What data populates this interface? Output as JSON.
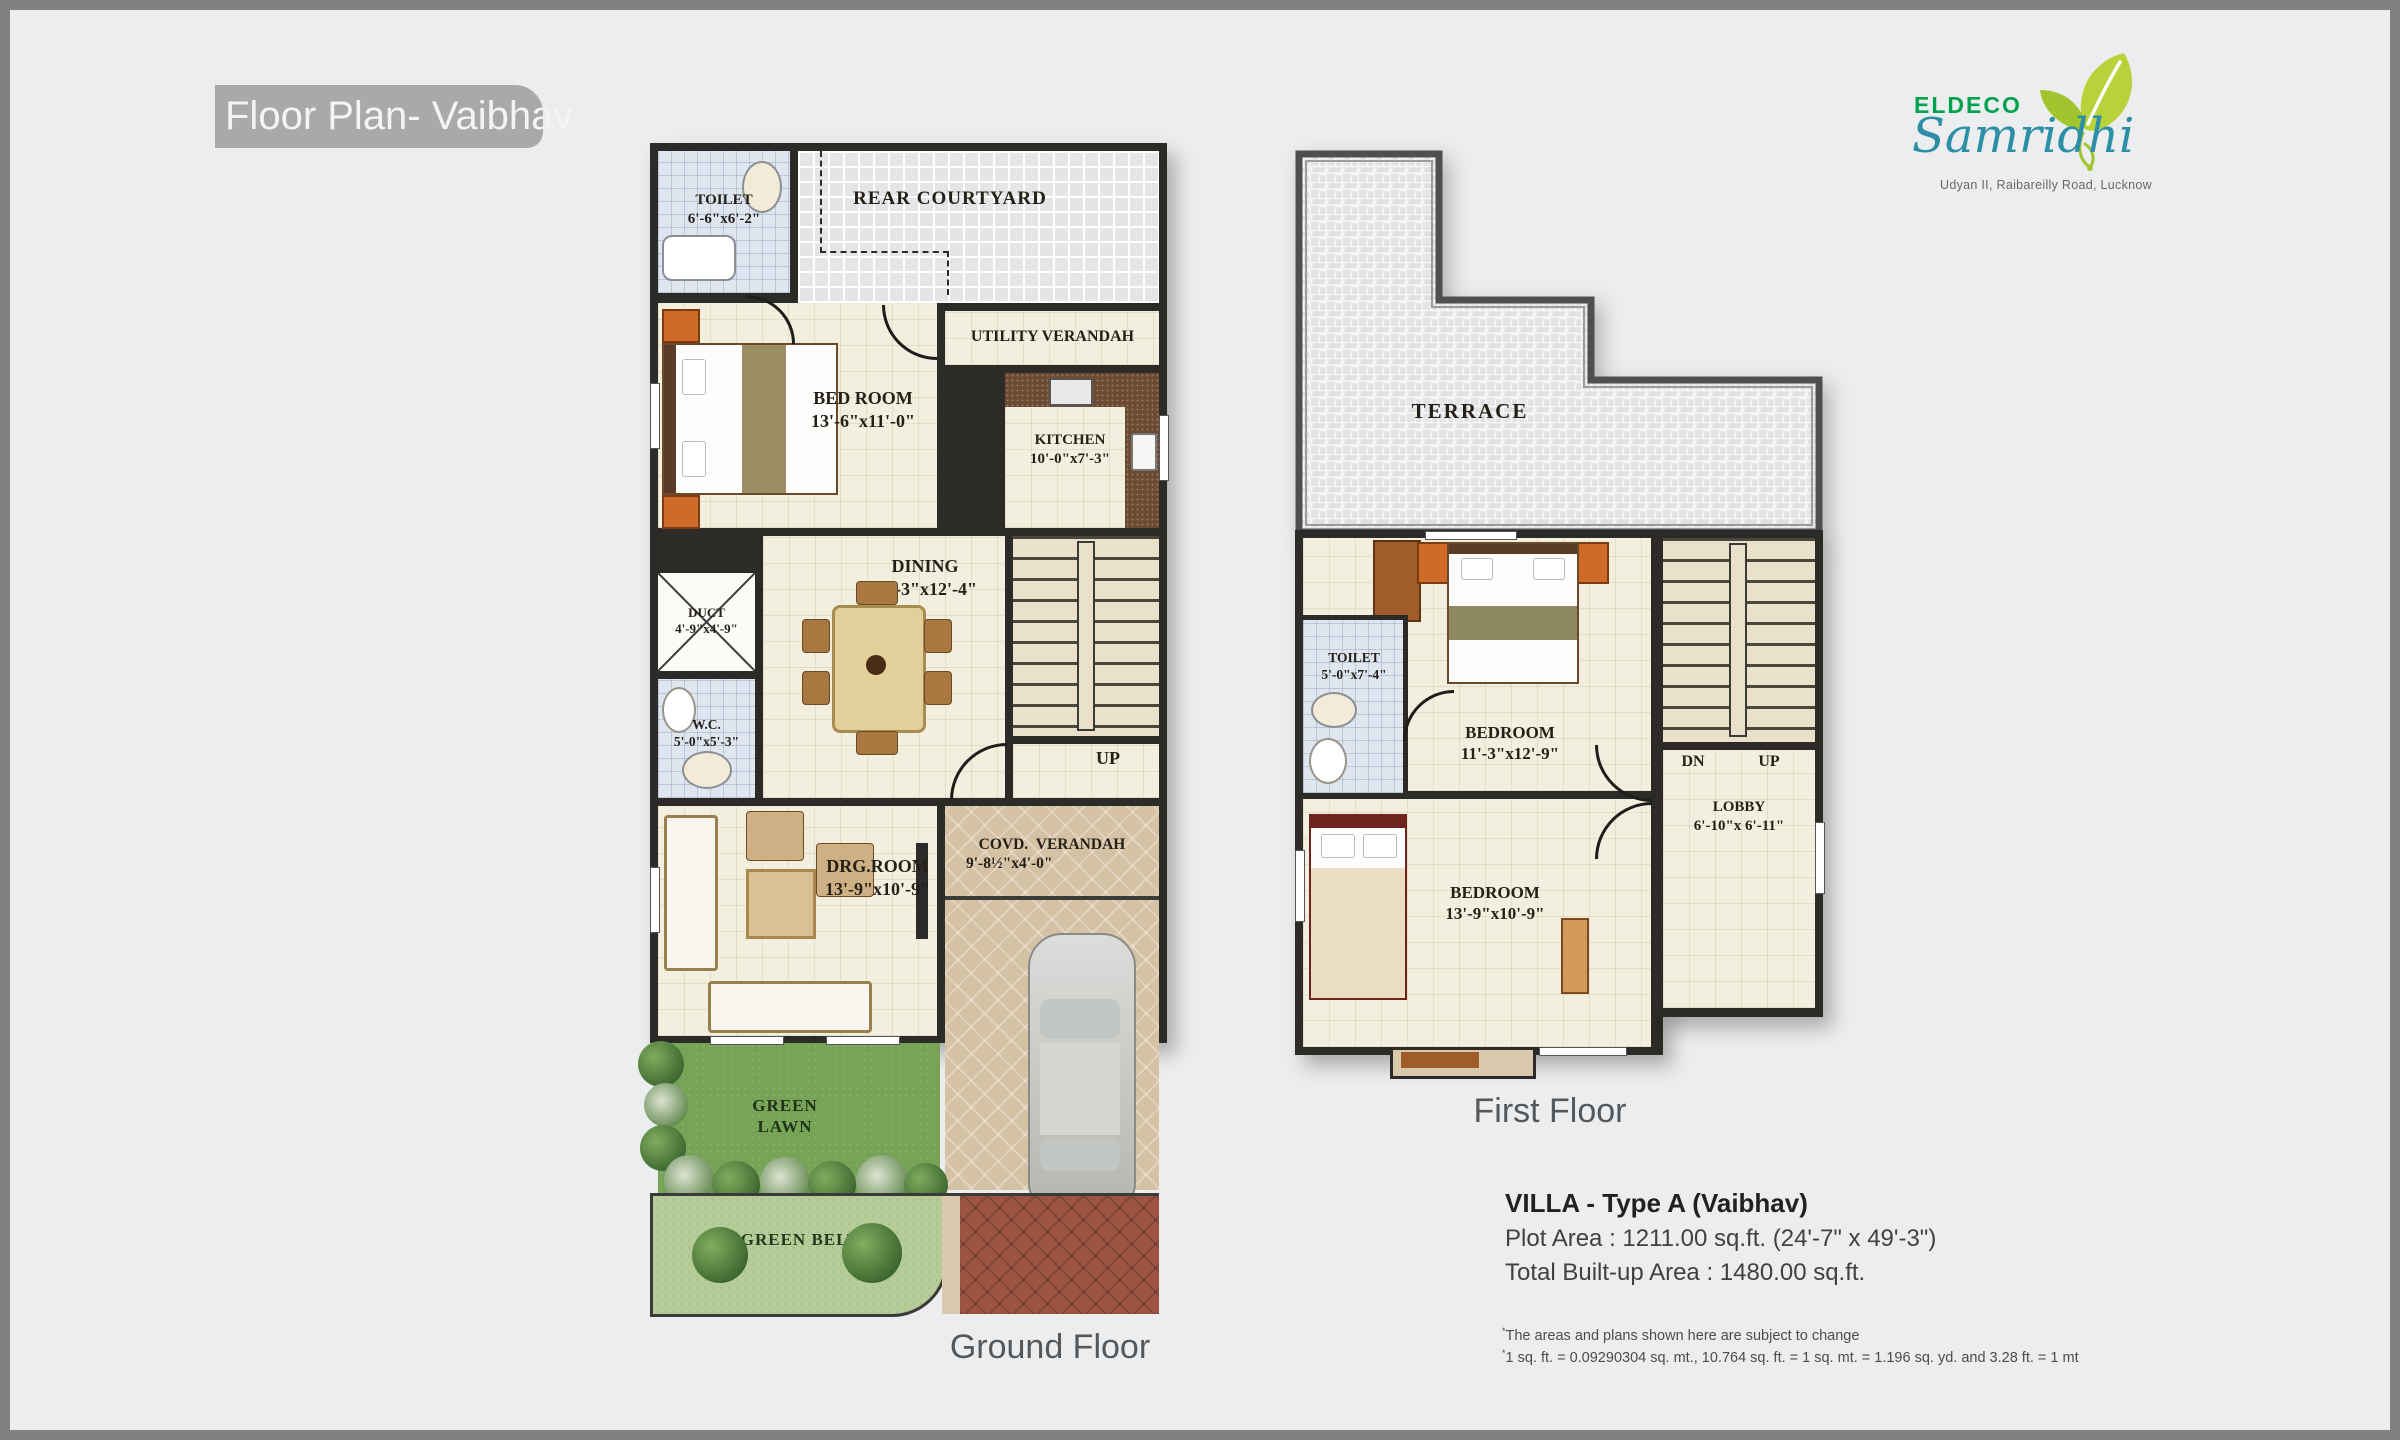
{
  "title": "Floor Plan- Vaibhav",
  "logo": {
    "brand": "ELDECO",
    "project": "Samridhi",
    "address": "Udyan II, Raibareilly Road, Lucknow"
  },
  "ground_floor": {
    "label": "Ground Floor",
    "toilet": {
      "name": "TOILET",
      "dims": "6'-6\"x6'-2\""
    },
    "rear_courtyard": {
      "name": "REAR COURTYARD"
    },
    "bed_room": {
      "name": "BED ROOM",
      "dims": "13'-6\"x11'-0\""
    },
    "utility_verandah": {
      "name": "UTILITY VERANDAH"
    },
    "kitchen": {
      "name": "KITCHEN",
      "dims": "10'-0\"x7'-3\""
    },
    "dining": {
      "name": "DINING",
      "dims": "11'-3\"x12'-4\""
    },
    "duct": {
      "name": "DUCT",
      "dims": "4'-9\"x4'-9\""
    },
    "wc": {
      "name": "W.C.",
      "dims": "5'-0\"x5'-3\""
    },
    "drg_room": {
      "name": "DRG.ROOM",
      "dims": "13'-9\"x10'-9\""
    },
    "covd_verandah": {
      "name": "COVD. VERANDAH",
      "dims": "9'-8½\"x4'-0\""
    },
    "green_lawn_line1": "GREEN",
    "green_lawn_line2": "LAWN",
    "green_belt": "GREEN BELT",
    "up": "UP"
  },
  "first_floor": {
    "label": "First Floor",
    "terrace": {
      "name": "TERRACE"
    },
    "toilet": {
      "name": "TOILET",
      "dims": "5'-0\"x7'-4\""
    },
    "bedroom1": {
      "name": "BEDROOM",
      "dims": "11'-3\"x12'-9\""
    },
    "lobby": {
      "name": "LOBBY",
      "dims": "6'-10\"x 6'-11\""
    },
    "bedroom2": {
      "name": "BEDROOM",
      "dims": "13'-9\"x10'-9\""
    },
    "dn": "DN",
    "up": "UP"
  },
  "details": {
    "villa_title": "VILLA - Type A (Vaibhav)",
    "plot_area": "Plot Area : 1211.00 sq.ft. (24'-7\" x 49'-3\")",
    "built_up": "Total Built-up Area : 1480.00 sq.ft.",
    "note_mark": "*",
    "note1": "The areas and plans shown here are subject to change",
    "note2": "1 sq. ft. = 0.09290304 sq. mt., 10.764 sq. ft. = 1 sq. mt. = 1.196 sq. yd. and 3.28 ft. = 1 mt"
  },
  "colors": {
    "page_bg": "#ebedef",
    "frame": "#7f8183",
    "title_bg": "#a7a9ab",
    "wall": "#2d2b28",
    "floor_cream": "#f2efdf",
    "tile_blue": "#dfe6ef",
    "paving_tan": "#d5c2a4",
    "brick_red": "#9d5541",
    "lawn_green": "#76a356",
    "belt_green": "#b6cc98",
    "logo_green": "#00a24f",
    "logo_teal": "#2c8fa6"
  }
}
